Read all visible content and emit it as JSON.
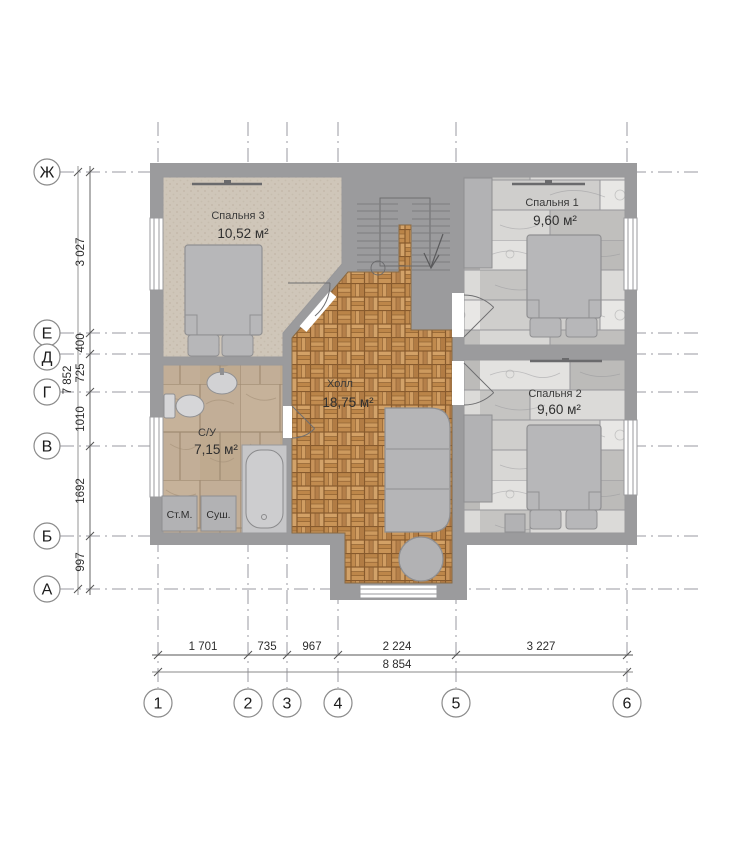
{
  "plan": {
    "rooms": [
      {
        "name": "Спальня 3",
        "area": "10,52 м²"
      },
      {
        "name": "Спальня 1",
        "area": "9,60 м²"
      },
      {
        "name": "Спальня 2",
        "area": "9,60 м²"
      },
      {
        "name": "Холл",
        "area": "18,75 м²"
      },
      {
        "name": "С/У",
        "area": "7,15 м²"
      }
    ],
    "appliances": {
      "washer": "Ст.М.",
      "dryer": "Суш."
    }
  },
  "axes": {
    "rows": [
      {
        "label": "Ж"
      },
      {
        "label": "Е"
      },
      {
        "label": "Д"
      },
      {
        "label": "Г"
      },
      {
        "label": "В"
      },
      {
        "label": "Б"
      },
      {
        "label": "А"
      }
    ],
    "cols": [
      {
        "label": "1"
      },
      {
        "label": "2"
      },
      {
        "label": "3"
      },
      {
        "label": "4"
      },
      {
        "label": "5"
      },
      {
        "label": "6"
      }
    ]
  },
  "dimensions": {
    "vertical_segments": [
      "3 027",
      "400",
      "725",
      "1010",
      "1692",
      "997"
    ],
    "vertical_total": "7 852",
    "horizontal_segments": [
      "1 701",
      "735",
      "967",
      "2 224",
      "3 227"
    ],
    "horizontal_total": "8 854"
  },
  "colors": {
    "wall": "#9b9b9d",
    "carpet": "#cfc6b9",
    "parquet": "#c08a4c",
    "tile": "#c2ae97",
    "furniture": "#b5b5b7",
    "grid": "#9a9aa0"
  }
}
